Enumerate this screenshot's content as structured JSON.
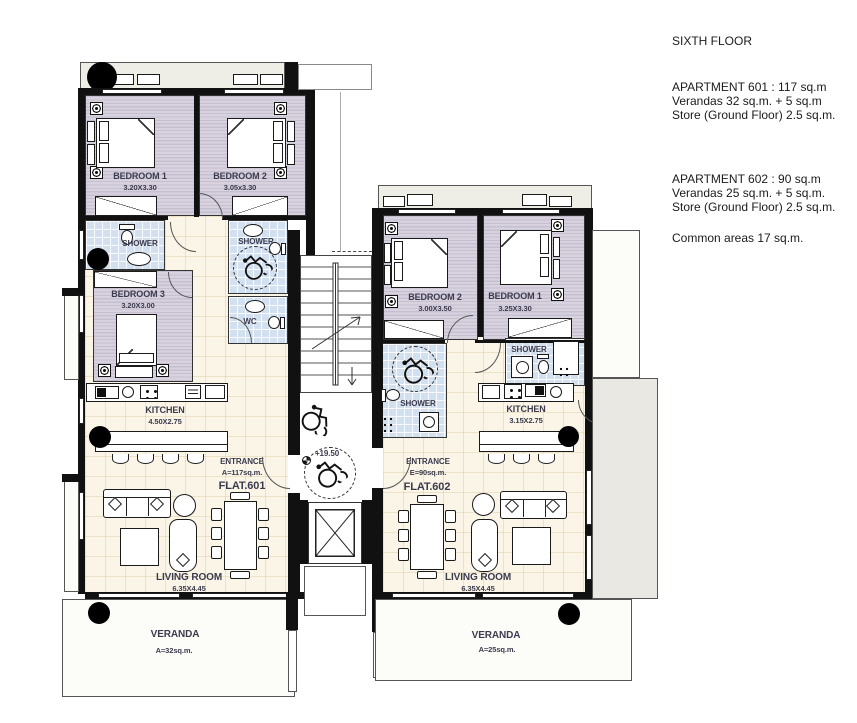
{
  "info_panel": {
    "floor_title": "SIXTH FLOOR",
    "apt601": [
      "APARTMENT 601 : 117 sq.m",
      "Verandas 32 sq.m. + 5 sq.m",
      "Store (Ground Floor) 2.5 sq.m."
    ],
    "apt602": [
      "APARTMENT 602 : 90 sq.m",
      "Verandas 25 sq.m. + 5 sq.m.",
      "Store (Ground Floor) 2.5 sq.m."
    ],
    "common_areas": "Common areas 17 sq.m."
  },
  "flat601": {
    "bedroom1": {
      "name": "BEDROOM 1",
      "dims": "3.20X3.30"
    },
    "bedroom2": {
      "name": "BEDROOM 2",
      "dims": "3.05x3.30"
    },
    "bedroom3": {
      "name": "BEDROOM 3",
      "dims": "3.20X3.00"
    },
    "shower1": {
      "name": "SHOWER"
    },
    "shower2": {
      "name": "SHOWER"
    },
    "wc": {
      "name": "WC"
    },
    "kitchen": {
      "name": "KITCHEN",
      "dims": "4.50X2.75"
    },
    "entrance": {
      "line1": "ENTRANCE",
      "line2": "A=117sq.m.",
      "flat": "FLAT.601"
    },
    "living": {
      "name": "LIVING ROOM",
      "dims": "6.35X4.45"
    },
    "veranda": {
      "name": "VERANDA",
      "area": "A=32sq.m."
    }
  },
  "flat602": {
    "bedroom2": {
      "name": "BEDROOM 2",
      "dims": "3.00X3.50"
    },
    "bedroom1": {
      "name": "BEDROOM 1",
      "dims": "3.25X3.30"
    },
    "shower_left": {
      "name": "SHOWER"
    },
    "shower_right": {
      "name": "SHOWER"
    },
    "kitchen": {
      "name": "KITCHEN",
      "dims": "3.15X2.75"
    },
    "entrance": {
      "line1": "ENTRANCE",
      "line2": "E=90sq.m.",
      "flat": "FLAT.602"
    },
    "living": {
      "name": "LIVING ROOM",
      "dims": "6.35X4.45"
    },
    "veranda": {
      "name": "VERANDA",
      "area": "A=25sq.m."
    }
  },
  "core": {
    "level_mark": "+19.50"
  },
  "icons": {
    "wheelchair-icon": "accessibility stencil (svg)",
    "column-marker": "filled black circle",
    "level-marker-icon": "survey point circle",
    "spotlight-icon": "square with fisheye ring",
    "stair-arrow-icon": "direction arrow"
  },
  "colors": {
    "wall": "#111111",
    "bedroom_floor": "#cfc8d6",
    "bath_floor": "#d3e0ef",
    "living_floor": "#faf5e6",
    "balcony_floor": "#eeeee6",
    "label_text": "#3b3b4e"
  }
}
